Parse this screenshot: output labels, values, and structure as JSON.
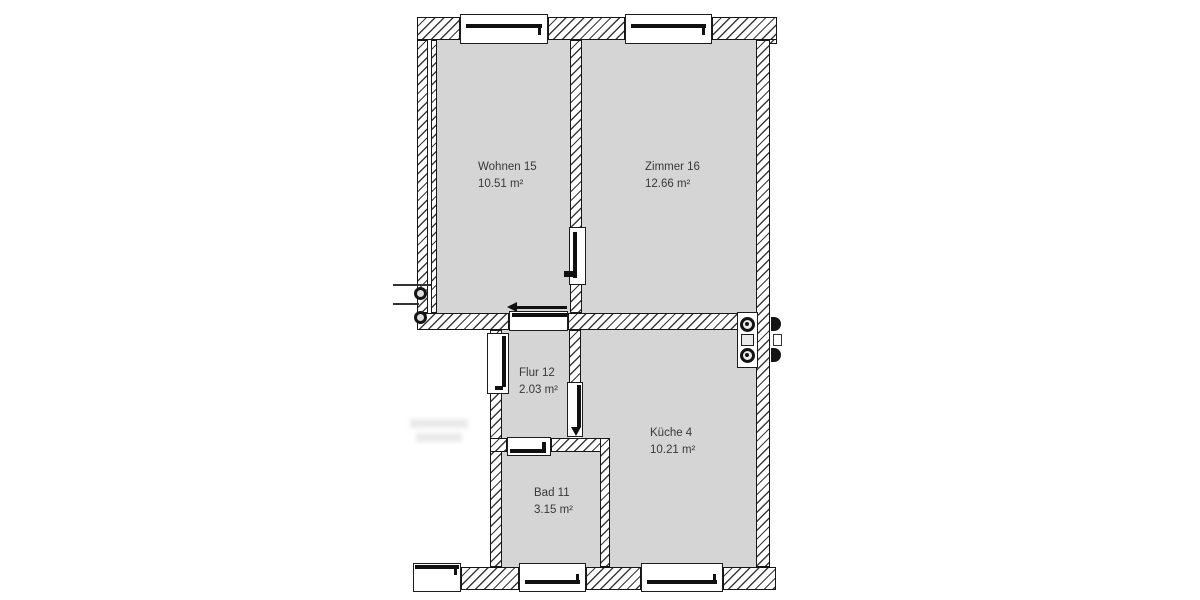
{
  "floorplan": {
    "type": "apartment-floor-plan",
    "rooms": [
      {
        "id": "wohnen",
        "name": "Wohnen 15",
        "area": "10.51 m²"
      },
      {
        "id": "zimmer",
        "name": "Zimmer 16",
        "area": "12.66 m²"
      },
      {
        "id": "flur",
        "name": "Flur 12",
        "area": "2.03 m²"
      },
      {
        "id": "kueche",
        "name": "Küche 4",
        "area": "10.21 m²"
      },
      {
        "id": "bad",
        "name": "Bad 11",
        "area": "3.15 m²"
      }
    ],
    "fixtures": {
      "kitchen_unit": "kitchen-unit-with-two-burner-circles",
      "pipe_risers": "two-pipe-riser-circles-on-left-wall"
    },
    "colors": {
      "background": "#ffffff",
      "room_fill": "#d5d5d5",
      "wall_line": "#161616",
      "hatch_line": "#3a3a3a",
      "label_text": "#383838"
    }
  }
}
